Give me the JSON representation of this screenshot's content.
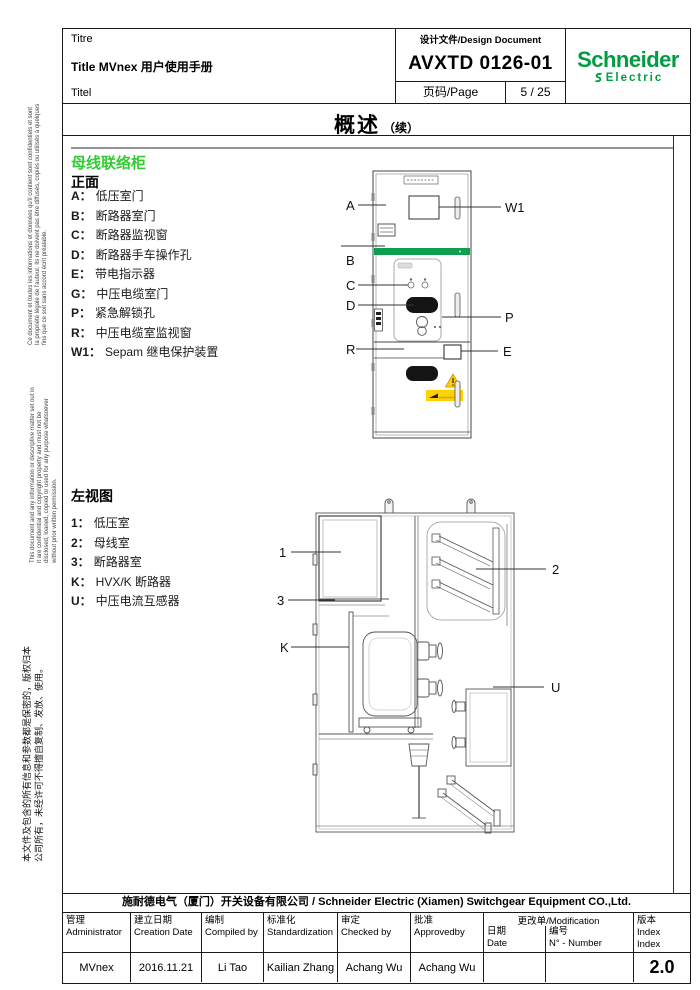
{
  "header": {
    "titre": "Titre",
    "title": "Title MVnex 用户使用手册",
    "titel": "Titel",
    "design_doc": "设计文件/Design Document",
    "doc_no": "AVXTD 0126-01",
    "page_label": "页码/Page",
    "page_value": "5 / 25",
    "brand": {
      "name": "Schneider",
      "sub": "Electric"
    }
  },
  "overview": {
    "title": "概述",
    "suffix": "（续）"
  },
  "side_notices": {
    "french": "Ce document et toutes les informations et données qu'il contient sont confidentiels et sont la propriété légale de l'auteur. Ils ne doivent pas être diffusés, copiés ou utilisés à quelques fins que ce soit sans accord écrit préalable.",
    "english": "This document and any information or descriptive matter set out in it are confidential and copyright property and must not be disclosed, loaned, copied or used for any purpose whatsoever without prior written permission.",
    "chinese": "本文件及包含的所有信息和参数都是保密的，版权归本公司所有，未经许可不得擅自复制、发放、使用。"
  },
  "section_front": {
    "heading": "母线联络柜",
    "subheading": "正面",
    "items": [
      {
        "k": "A：",
        "v": "低压室门"
      },
      {
        "k": "B：",
        "v": "断路器室门"
      },
      {
        "k": "C：",
        "v": "断路器监视窗"
      },
      {
        "k": "D：",
        "v": "断路器手车操作孔"
      },
      {
        "k": "E：",
        "v": "带电指示器"
      },
      {
        "k": "G：",
        "v": "中压电缆室门"
      },
      {
        "k": "P：",
        "v": "紧急解锁孔"
      },
      {
        "k": "R：",
        "v": "中压电缆室监视窗"
      },
      {
        "k": "W1：",
        "v": "Sepam 继电保护装置"
      }
    ]
  },
  "section_side": {
    "heading": "左视图",
    "items": [
      {
        "k": "1：",
        "v": "低压室"
      },
      {
        "k": "2：",
        "v": "母线室"
      },
      {
        "k": "3：",
        "v": "断路器室"
      },
      {
        "k": "K：",
        "v": "HVX/K 断路器"
      },
      {
        "k": "U：",
        "v": "中压电流互感器"
      }
    ]
  },
  "front_diagram": {
    "labels": {
      "a": "A",
      "b": "B",
      "c": "C",
      "d": "D",
      "r": "R",
      "w1": "W1",
      "p": "P",
      "e": "E"
    }
  },
  "side_diagram": {
    "labels": {
      "n1": "1",
      "n2": "2",
      "n3": "3",
      "k": "K",
      "u": "U"
    }
  },
  "footer": {
    "company": "施耐德电气（厦门）开关设备有限公司 / Schneider Electric  (Xiamen) Switchgear Equipment CO.,Ltd.",
    "columns": [
      {
        "zh": "管理",
        "en": "Administrator",
        "value": "MVnex"
      },
      {
        "zh": "建立日期",
        "en": "Creation Date",
        "value": "2016.11.21"
      },
      {
        "zh": "编制",
        "en": "Compiled by",
        "value": "Li Tao"
      },
      {
        "zh": "标准化",
        "en": "Standardization",
        "value": "Kailian Zhang"
      },
      {
        "zh": "审定",
        "en": "Checked by",
        "value": "Achang Wu"
      },
      {
        "zh": "批准",
        "en": "Approvedby",
        "value": "Achang Wu"
      }
    ],
    "modification": {
      "title": "更改单/Modification",
      "date_zh": "日期",
      "date_en": "Date",
      "no_zh": "编号",
      "no_en": "N° - Number",
      "date_value": "",
      "no_value": ""
    },
    "index": {
      "l1": "版本",
      "l2": "Index",
      "l3": "Index",
      "value": "2.0"
    }
  },
  "colors": {
    "brand_green": "#009E40",
    "heading_green": "#33CC33",
    "band_green": "#0F9D4F",
    "warning_yellow": "#FFD100"
  }
}
